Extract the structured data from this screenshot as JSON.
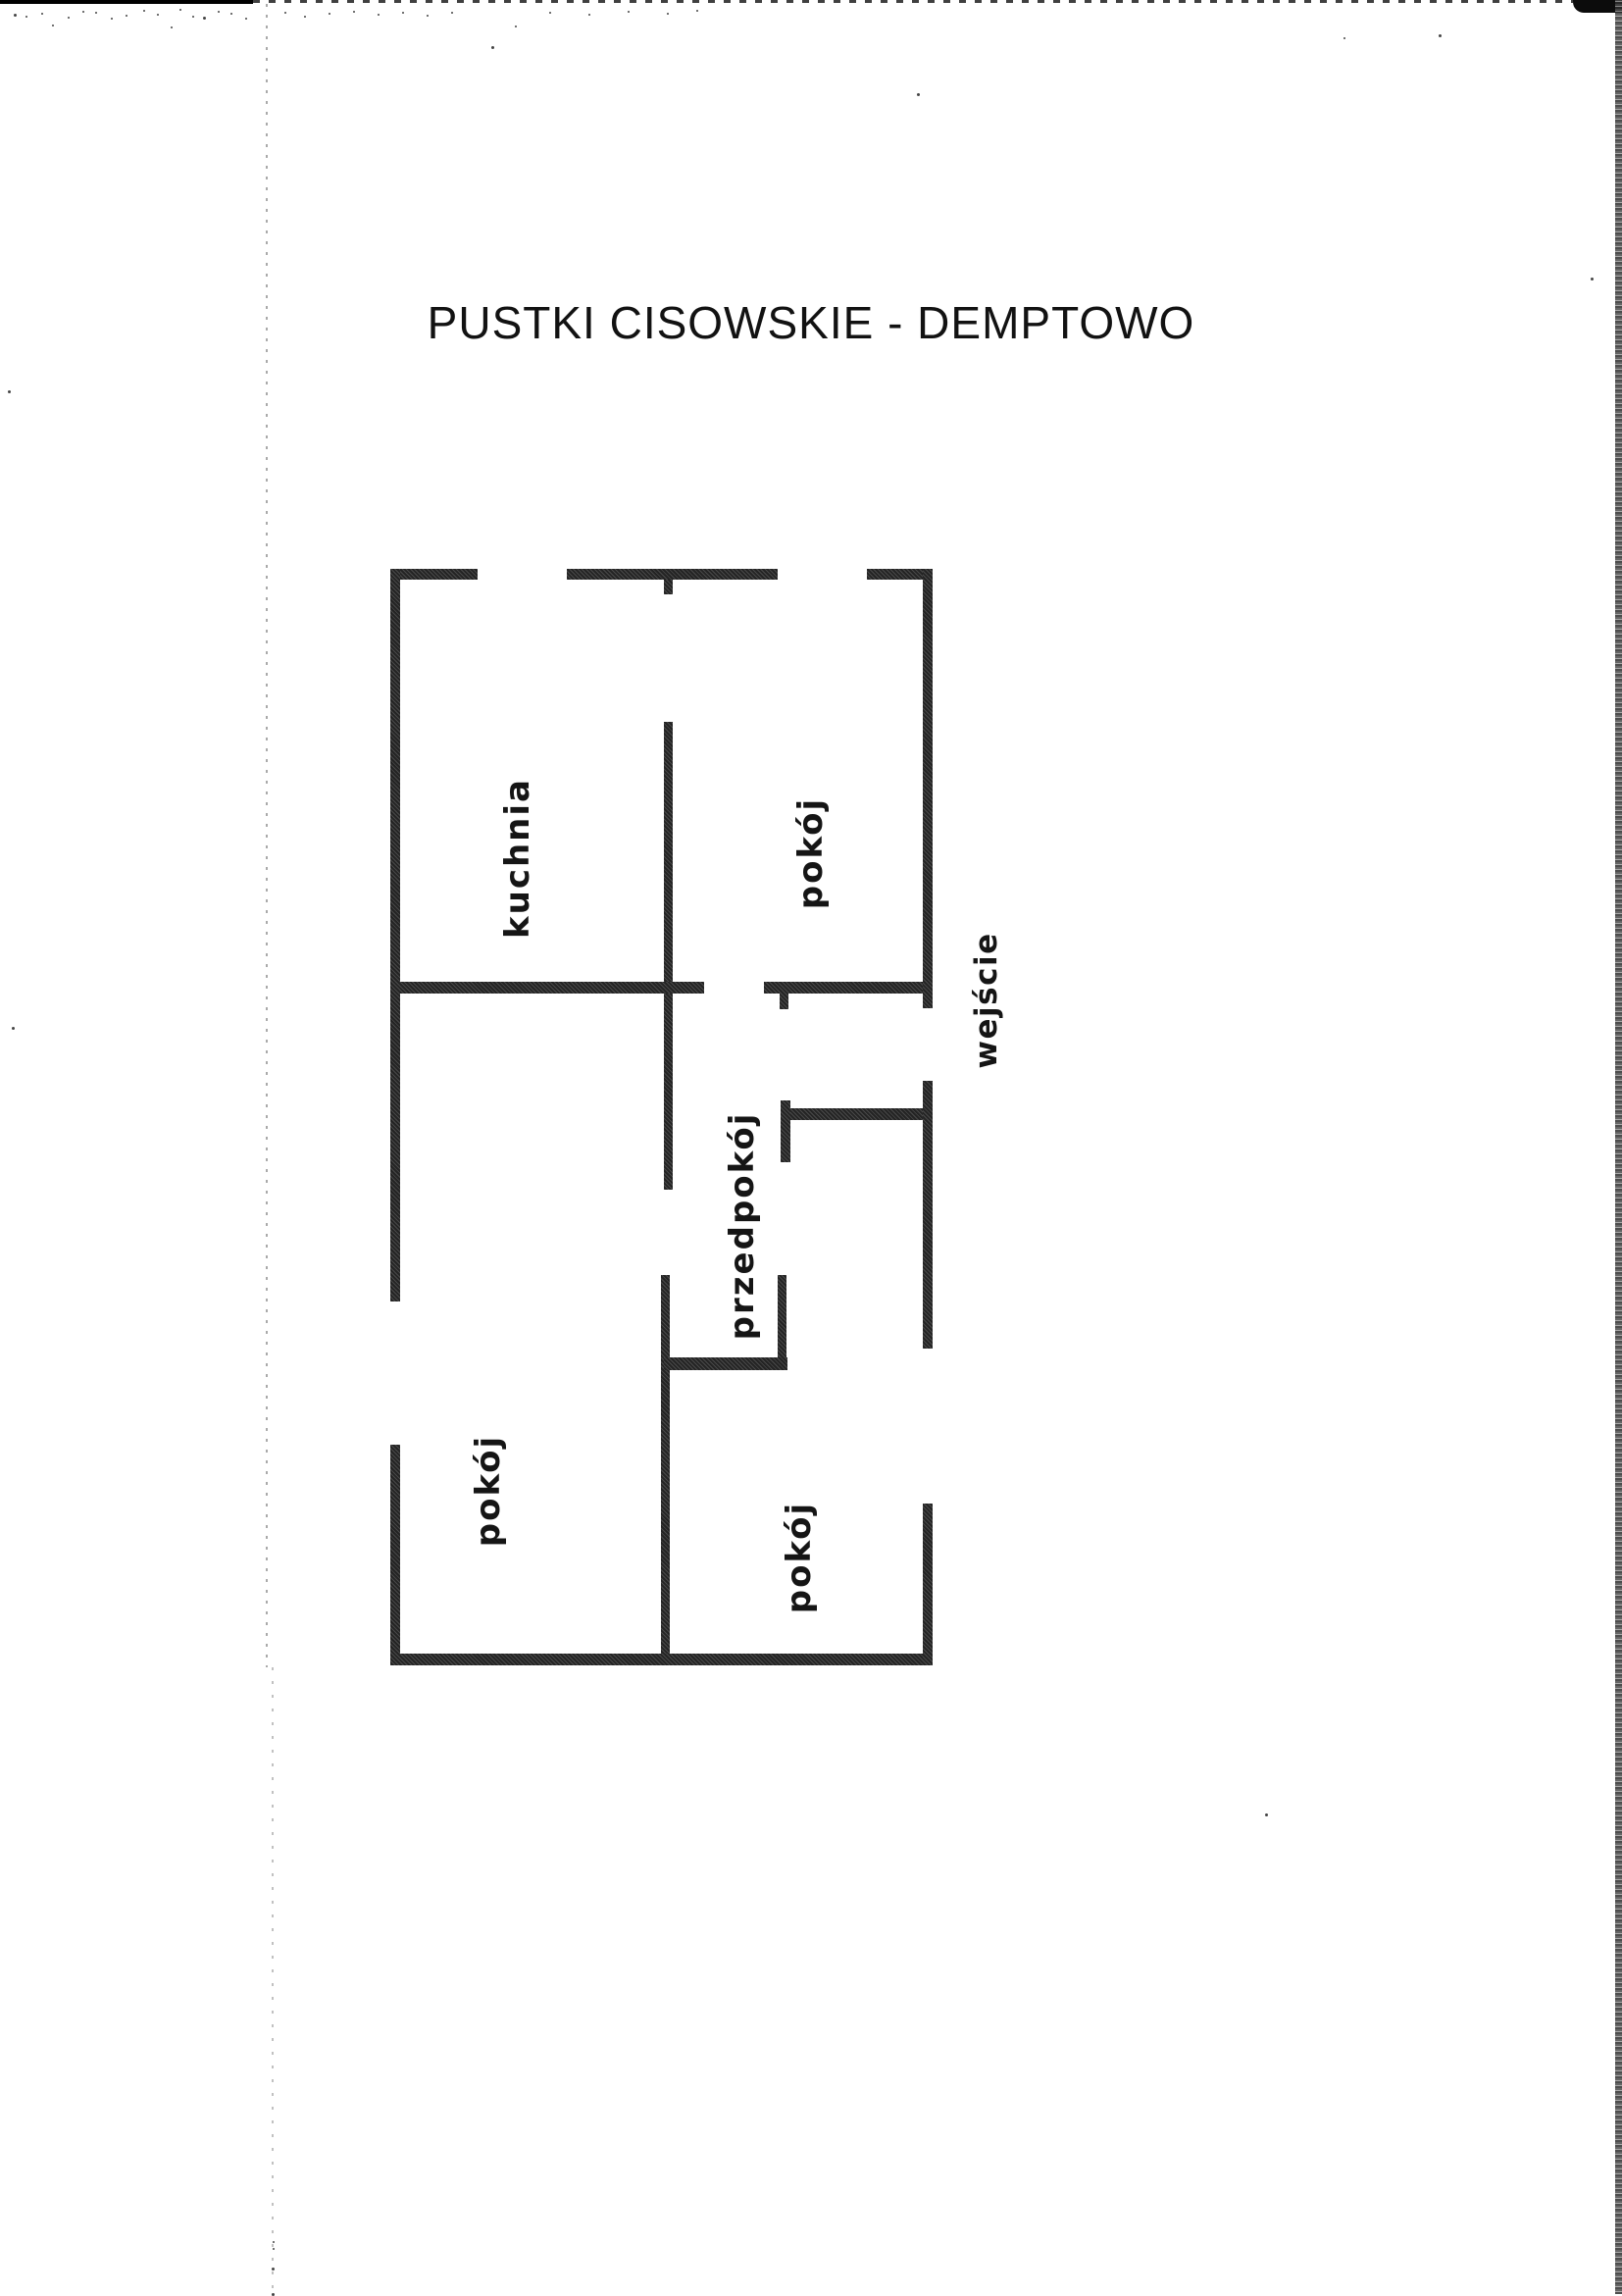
{
  "document": {
    "title": "PUSTKI CISOWSKIE - DEMPTOWO"
  },
  "floor_plan": {
    "rooms": [
      {
        "id": "kuchnia",
        "label": "kuchnia"
      },
      {
        "id": "pokoj-gorny-prawy",
        "label": "pokój"
      },
      {
        "id": "przedpokoj",
        "label": "przedpokój"
      },
      {
        "id": "pokoj-dolny-lewy",
        "label": "pokój"
      },
      {
        "id": "pokoj-dolny-prawy",
        "label": "pokój"
      }
    ],
    "entrance": {
      "label": "wejście"
    },
    "ink_color": "#242424",
    "paper_color": "#ffffff"
  }
}
